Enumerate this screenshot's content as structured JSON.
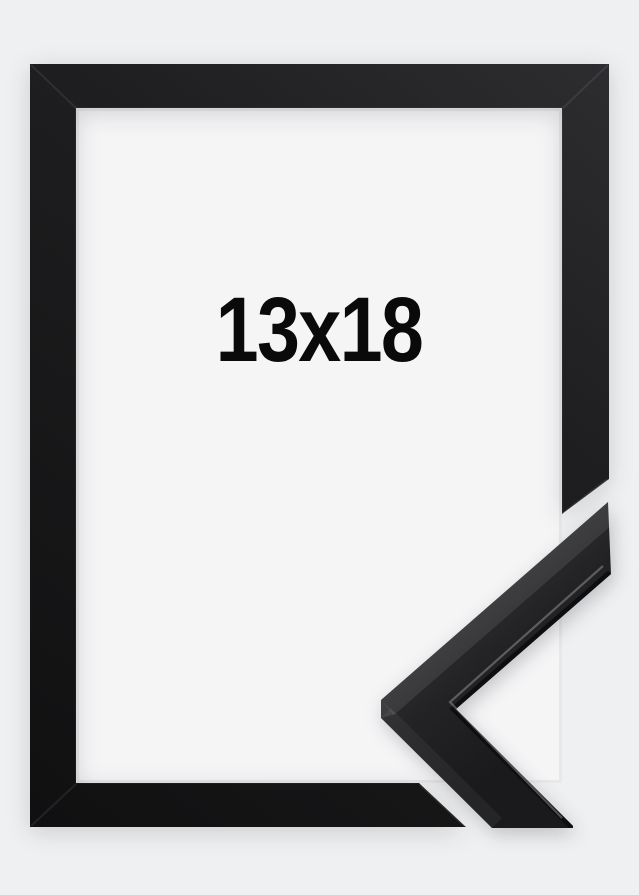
{
  "product": {
    "size_label": "13x18",
    "frame_color_name": "Black"
  },
  "colors": {
    "background": "#eff0f1",
    "inner_area": "#f5f5f6",
    "frame_dark": "#1d1d1f",
    "frame_light_edge": "#3a3a3d",
    "label_text": "#0a0a0b"
  }
}
